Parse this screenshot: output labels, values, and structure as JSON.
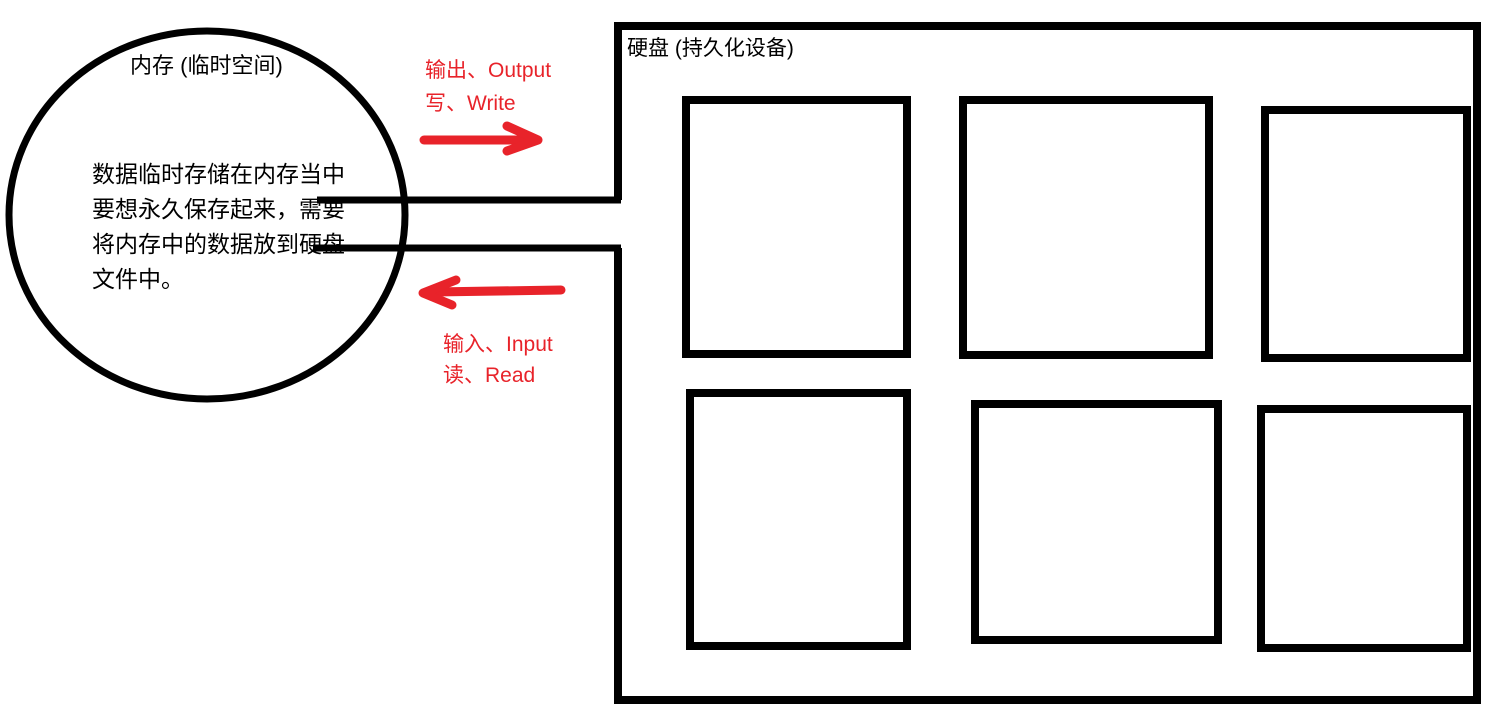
{
  "meta": {
    "background_color": "#ffffff",
    "ink_color": "#000000",
    "marker_color": "#e8232a"
  },
  "memory": {
    "title": "内存 (临时空间)",
    "body_lines": [
      "数据临时存储在内存当中",
      "要想永久保存起来，需要",
      "将内存中的数据放到硬盘",
      "文件中。"
    ]
  },
  "disk": {
    "title": "硬盘 (持久化设备)",
    "slot_count": 6
  },
  "flows": {
    "output": {
      "direction": "right",
      "label_line1": "输出、Output",
      "label_line2": "写、Write"
    },
    "input": {
      "direction": "left",
      "label_line1": "输入、Input",
      "label_line2": "读、Read"
    }
  }
}
